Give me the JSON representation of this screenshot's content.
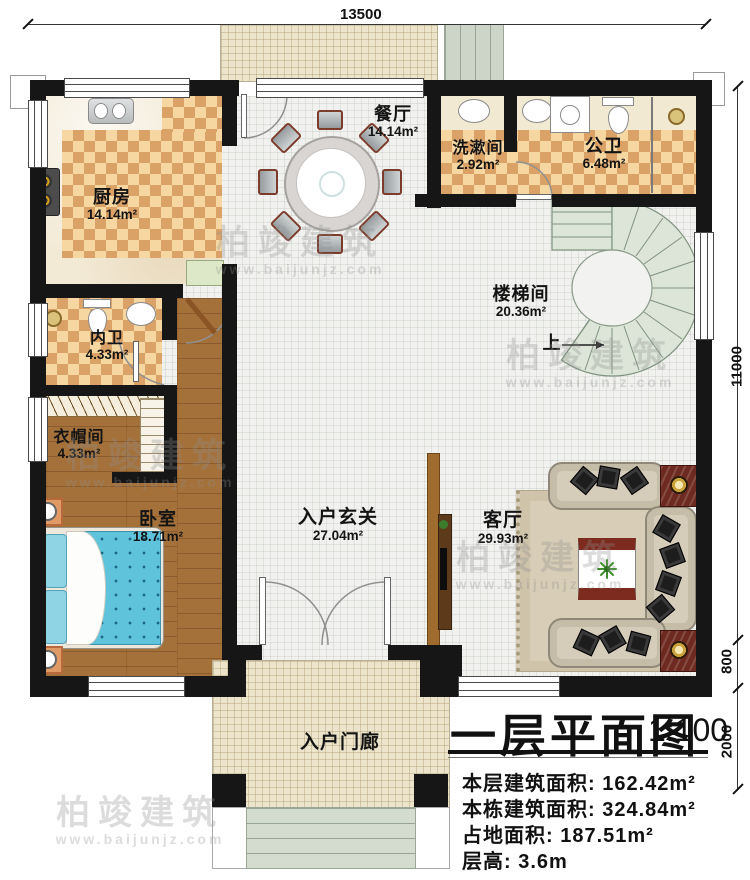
{
  "title_block": {
    "title": "一层平面图",
    "scale": "1:100",
    "lines": [
      "本层建筑面积: 162.42m²",
      "本栋建筑面积: 324.84m²",
      "占地面积: 187.51m²",
      "层高: 3.6m"
    ]
  },
  "dimensions": {
    "top": "13500",
    "right_total": "11000",
    "right_mid": "800",
    "right_bottom": "2000"
  },
  "rooms": [
    {
      "name": "厨房",
      "area": "14.14m²"
    },
    {
      "name": "餐厅",
      "area": "14.14m²"
    },
    {
      "name": "洗漱间",
      "area": "2.92m²"
    },
    {
      "name": "公卫",
      "area": "6.48m²"
    },
    {
      "name": "楼梯间",
      "area": "20.36m²"
    },
    {
      "name": "内卫",
      "area": "4.33m²"
    },
    {
      "name": "衣帽间",
      "area": "4.33m²"
    },
    {
      "name": "卧室",
      "area": "18.71m²"
    },
    {
      "name": "入户玄关",
      "area": "27.04m²"
    },
    {
      "name": "客厅",
      "area": "29.93m²"
    }
  ],
  "porch_label": "入户门廊",
  "stair_up_label": "上",
  "watermark": {
    "name": "柏竣建筑",
    "url": "www.baijunjz.com"
  },
  "colors": {
    "wall": "#161616",
    "checker": "#dba267",
    "wood": "#a4713b",
    "bed": "#5fc3dc",
    "stair": "#dde5d8"
  }
}
